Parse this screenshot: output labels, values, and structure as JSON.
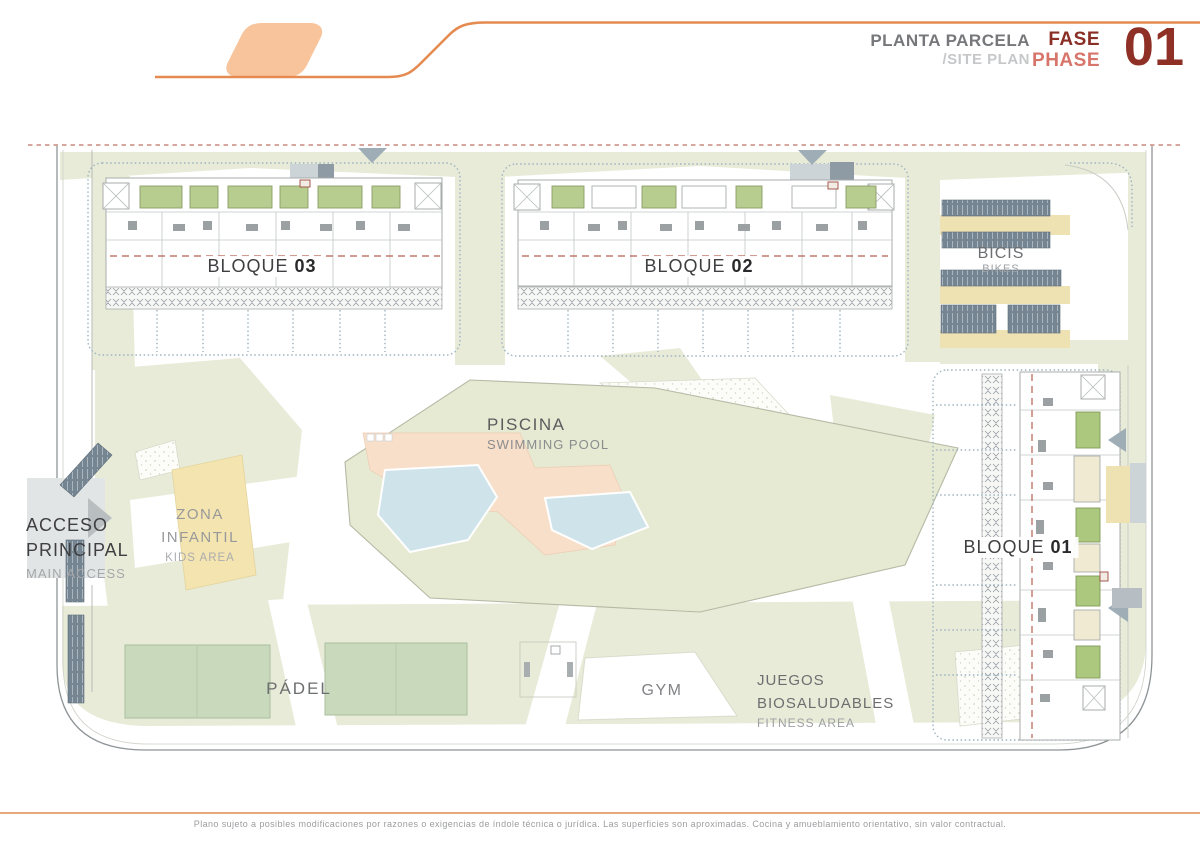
{
  "header": {
    "title_es": "PLANTA PARCELA",
    "title_en": "/SITE PLAN",
    "phase_es": "FASE",
    "phase_en": "PHASE",
    "phase_number": "01"
  },
  "plan": {
    "blocks": {
      "b03": {
        "prefix": "BLOQUE ",
        "number": "03"
      },
      "b02": {
        "prefix": "BLOQUE ",
        "number": "02"
      },
      "b01": {
        "prefix": "BLOQUE ",
        "number": "01"
      }
    },
    "bikes": {
      "es": "BICIS",
      "en": "BIKES"
    },
    "pool": {
      "es": "PISCINA",
      "en": "SWIMMING POOL"
    },
    "kids": {
      "es_line1": "ZONA",
      "es_line2": "INFANTIL",
      "en": "KIDS AREA"
    },
    "access": {
      "es_line1": "ACCESO",
      "es_line2": "PRINCIPAL",
      "en": "MAIN ACCESS"
    },
    "padel": {
      "es": "PÁDEL"
    },
    "gym": {
      "es": "GYM"
    },
    "fitness": {
      "es_line1": "JUEGOS",
      "es_line2": "BIOSALUDABLES",
      "en": "FITNESS AREA"
    }
  },
  "footer": {
    "disclaimer": "Plano sujeto a posibles modificaciones por razones o exigencias de índole técnica o jurídica. Las superficies son aproximadas. Cocina y amueblamiento orientativo, sin valor contractual."
  },
  "colors": {
    "accent_orange": "#e58b52",
    "logo_fill": "#f8c49c",
    "dark_red": "#8e3026",
    "light_red": "#d8756b",
    "boundary_dash": "#c98a7e",
    "green_light": "#e8ebd8",
    "court_green": "#c9dabc",
    "roof_green": "#b5cb8e",
    "kids_yellow": "#f4e4b0",
    "pool_blue": "#cfe3ea",
    "deck_peach": "#f8dfc9",
    "bikes_tan": "#eee1b2",
    "rack_slate": "#758592"
  }
}
